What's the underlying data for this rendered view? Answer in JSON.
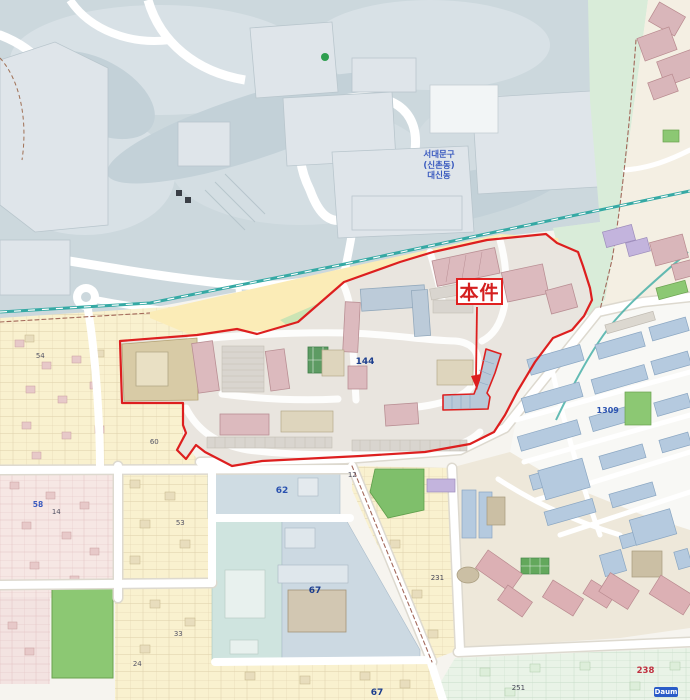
{
  "map": {
    "subject_label": {
      "text": "本件"
    },
    "provider_logo": {
      "text": "Daum"
    },
    "colors": {
      "subject_boundary": "#dd1f1f",
      "railway": "#35a9a4",
      "hill": "#ccd8dd",
      "park_green": "#8cc873",
      "cadastral_yellow": "#f9f1cf",
      "cadastral_pink": "#f6e7e4",
      "apartment_pink": "#dcbabe",
      "rowhouse_blue": "#b5cadf",
      "beige_residential": "#f4efe3"
    },
    "labels": [
      {
        "name": "district-label",
        "text": "서대문구\n(신촌동)\n대신동",
        "x": 424,
        "y": 150,
        "color": "#3b5bbf",
        "size": 8.5,
        "bold": true,
        "multiline": true,
        "align": "center"
      },
      {
        "name": "parcel-number-144",
        "text": "144",
        "x": 356,
        "y": 357,
        "color": "#1c3e8e",
        "size": 9,
        "bold": true
      },
      {
        "name": "parcel-number-62",
        "text": "62",
        "x": 276,
        "y": 486,
        "color": "#2a52b0",
        "size": 9,
        "bold": true
      },
      {
        "name": "parcel-number-67-campus",
        "text": "67",
        "x": 309,
        "y": 586,
        "color": "#1c3e8e",
        "size": 9,
        "bold": true
      },
      {
        "name": "parcel-number-67-south",
        "text": "67",
        "x": 371,
        "y": 688,
        "color": "#1c3e8e",
        "size": 9,
        "bold": true
      },
      {
        "name": "parcel-number-1309",
        "text": "1309",
        "x": 597,
        "y": 406,
        "color": "#2a52b0",
        "size": 8,
        "bold": true
      },
      {
        "name": "parcel-number-238",
        "text": "238",
        "x": 637,
        "y": 666,
        "color": "#c03040",
        "size": 8.5,
        "bold": true
      },
      {
        "name": "parcel-number-231",
        "text": "231",
        "x": 431,
        "y": 574,
        "color": "#445",
        "size": 7
      },
      {
        "name": "parcel-number-251",
        "text": "251",
        "x": 512,
        "y": 684,
        "color": "#445",
        "size": 7
      },
      {
        "name": "parcel-number-54",
        "text": "54",
        "x": 36,
        "y": 352,
        "color": "#556",
        "size": 7
      },
      {
        "name": "parcel-number-58",
        "text": "58",
        "x": 33,
        "y": 500,
        "color": "#3b5bbf",
        "size": 7.5,
        "bold": true
      },
      {
        "name": "parcel-number-14",
        "text": "14",
        "x": 52,
        "y": 508,
        "color": "#556",
        "size": 7
      },
      {
        "name": "parcel-number-24",
        "text": "24",
        "x": 133,
        "y": 660,
        "color": "#556",
        "size": 7
      },
      {
        "name": "parcel-number-53",
        "text": "53",
        "x": 176,
        "y": 519,
        "color": "#556",
        "size": 7
      },
      {
        "name": "parcel-number-33",
        "text": "33",
        "x": 174,
        "y": 630,
        "color": "#556",
        "size": 7
      },
      {
        "name": "parcel-number-12",
        "text": "12",
        "x": 348,
        "y": 471,
        "color": "#556",
        "size": 7
      },
      {
        "name": "parcel-number-60",
        "text": "60",
        "x": 150,
        "y": 438,
        "color": "#556",
        "size": 7
      }
    ]
  }
}
